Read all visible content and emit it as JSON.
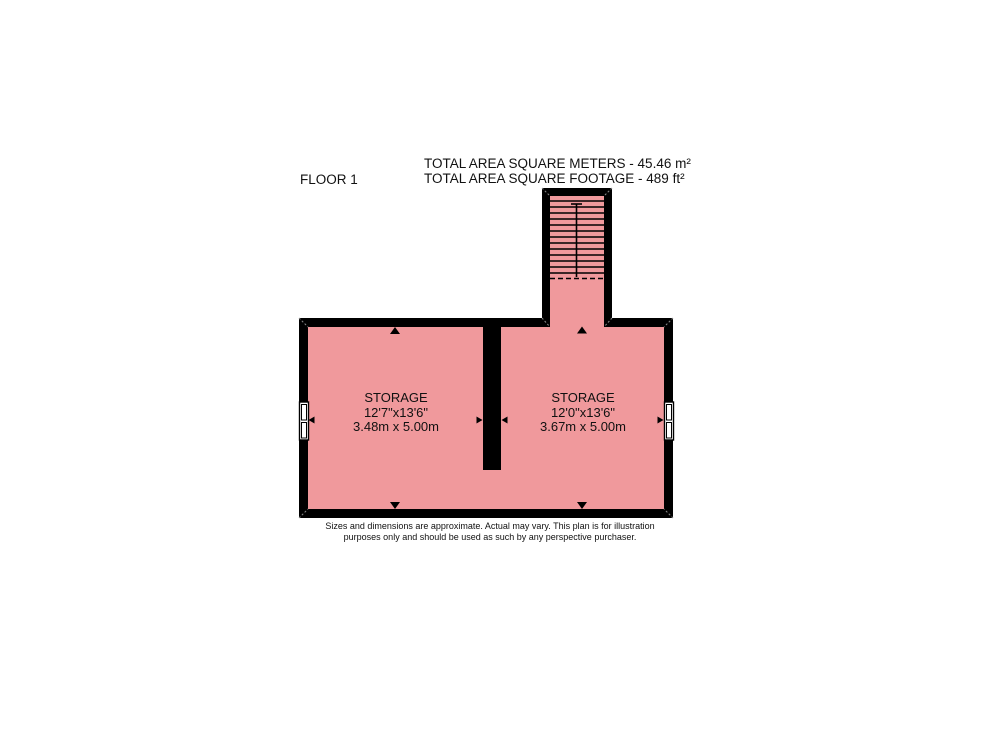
{
  "header": {
    "floor_label": "FLOOR 1",
    "total_area_meters": "TOTAL AREA SQUARE METERS - 45.46 m²",
    "total_area_footage": "TOTAL AREA SQUARE FOOTAGE - 489 ft²"
  },
  "rooms": [
    {
      "name": "STORAGE",
      "dimensions_imperial": "12'7\"x13'6\"",
      "dimensions_metric": "3.48m x 5.00m"
    },
    {
      "name": "STORAGE",
      "dimensions_imperial": "12'0\"x13'6\"",
      "dimensions_metric": "3.67m x 5.00m"
    }
  ],
  "disclaimer": {
    "line1": "Sizes and dimensions are approximate. Actual may vary. This plan is for illustration",
    "line2": "purposes only and should be used as such by any perspective purchaser."
  },
  "colors": {
    "room_fill": "#f0999c",
    "wall": "#000000",
    "window_fill": "#ffffff",
    "mitre_line": "#8a8a8a",
    "text": "#111111",
    "page_bg": "#ffffff"
  }
}
